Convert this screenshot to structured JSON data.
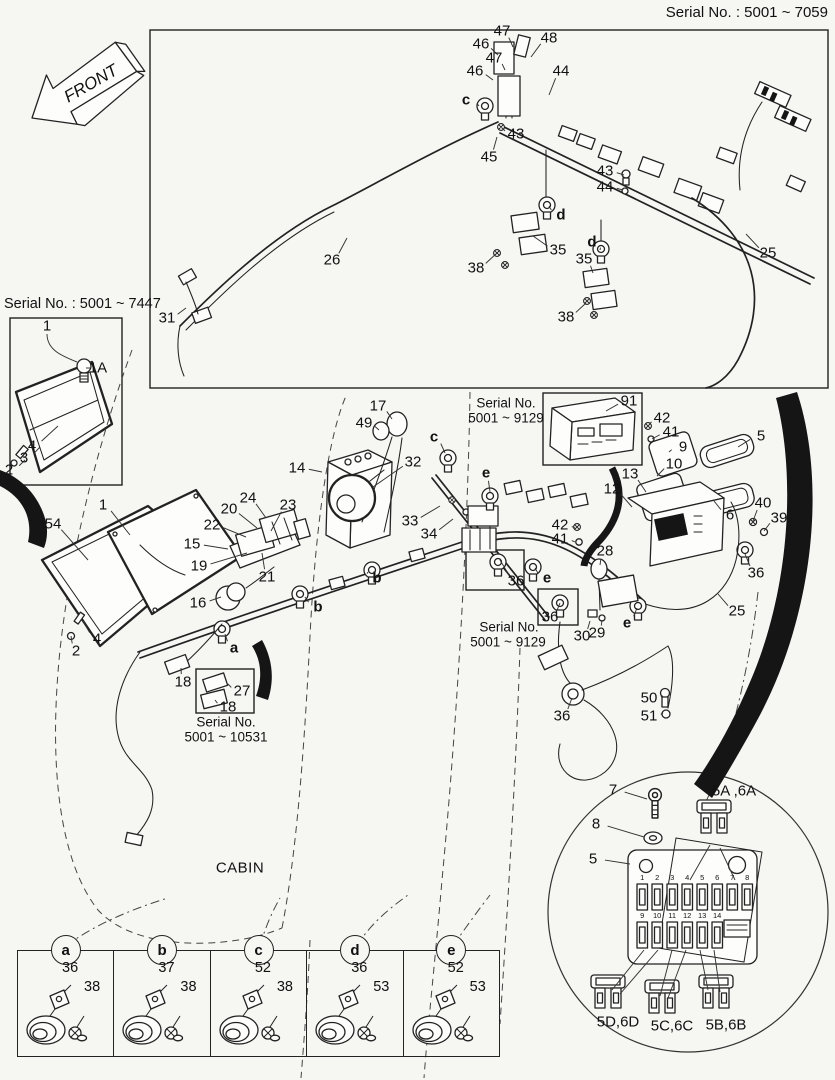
{
  "front_arrow": {
    "label": "FRONT"
  },
  "headers": {
    "top_right_serial": "Serial No. : 5001 ~ 7059",
    "left_box_serial": "Serial No. : 5001 ~ 7447"
  },
  "callouts": [
    {
      "t": "47",
      "x": 502,
      "y": 31,
      "tx": 513,
      "ty": 47
    },
    {
      "t": "46",
      "x": 481,
      "y": 44,
      "tx": 498,
      "ty": 55
    },
    {
      "t": "47",
      "x": 494,
      "y": 58,
      "tx": 505,
      "ty": 70
    },
    {
      "t": "46",
      "x": 475,
      "y": 71,
      "tx": 493,
      "ty": 80
    },
    {
      "t": "48",
      "x": 549,
      "y": 38,
      "tx": 531,
      "ty": 57
    },
    {
      "t": "44",
      "x": 561,
      "y": 71,
      "tx": 549,
      "ty": 95
    },
    {
      "t": "c",
      "x": 466,
      "y": 100,
      "cls": "letter",
      "tx": 479,
      "ty": 106
    },
    {
      "t": "43",
      "x": 516,
      "y": 134,
      "tx": 502,
      "ty": 128
    },
    {
      "t": "45",
      "x": 489,
      "y": 157,
      "tx": 497,
      "ty": 137
    },
    {
      "t": "43",
      "x": 605,
      "y": 171,
      "tx": 624,
      "ty": 175
    },
    {
      "t": "44",
      "x": 605,
      "y": 187,
      "tx": 623,
      "ty": 190
    },
    {
      "t": "d",
      "x": 561,
      "y": 215,
      "cls": "letter",
      "tx": 549,
      "ty": 206
    },
    {
      "t": "35",
      "x": 558,
      "y": 250,
      "tx": 533,
      "ty": 236
    },
    {
      "t": "38",
      "x": 476,
      "y": 268,
      "tx": 497,
      "ty": 253
    },
    {
      "t": "d",
      "x": 592,
      "y": 242,
      "cls": "letter",
      "tx": 600,
      "ty": 250
    },
    {
      "t": "35",
      "x": 584,
      "y": 259,
      "tx": 593,
      "ty": 273
    },
    {
      "t": "38",
      "x": 566,
      "y": 317,
      "tx": 586,
      "ty": 303
    },
    {
      "t": "26",
      "x": 332,
      "y": 260,
      "tx": 347,
      "ty": 238
    },
    {
      "t": "31",
      "x": 167,
      "y": 318,
      "tx": 186,
      "ty": 308
    },
    {
      "t": "25",
      "x": 768,
      "y": 253,
      "tx": 746,
      "ty": 234
    },
    {
      "t": "1",
      "x": 47,
      "y": 326
    },
    {
      "t": "1A",
      "x": 98,
      "y": 368,
      "tx": 90,
      "ty": 368
    },
    {
      "t": "4",
      "x": 32,
      "y": 446,
      "tx": 58,
      "ty": 426
    },
    {
      "t": "3",
      "x": 24,
      "y": 458,
      "tx": 40,
      "ty": 447
    },
    {
      "t": "2",
      "x": 9,
      "y": 470,
      "tx": 25,
      "ty": 460
    },
    {
      "t": "54",
      "x": 53,
      "y": 524,
      "tx": 88,
      "ty": 560
    },
    {
      "t": "1",
      "x": 103,
      "y": 505,
      "tx": 130,
      "ty": 535
    },
    {
      "t": "4",
      "x": 97,
      "y": 639,
      "tx": 83,
      "ty": 621
    },
    {
      "t": "2",
      "x": 76,
      "y": 651,
      "tx": 71,
      "ty": 636
    },
    {
      "t": "15",
      "x": 192,
      "y": 544,
      "tx": 228,
      "ty": 549
    },
    {
      "t": "19",
      "x": 199,
      "y": 566,
      "tx": 247,
      "ty": 553
    },
    {
      "t": "22",
      "x": 212,
      "y": 525,
      "tx": 246,
      "ty": 537
    },
    {
      "t": "20",
      "x": 229,
      "y": 509,
      "tx": 257,
      "ty": 528
    },
    {
      "t": "24",
      "x": 248,
      "y": 498,
      "tx": 266,
      "ty": 518
    },
    {
      "t": "23",
      "x": 288,
      "y": 505,
      "tx": 271,
      "ty": 531
    },
    {
      "t": "21",
      "x": 267,
      "y": 577,
      "tx": 262,
      "ty": 553
    },
    {
      "t": "16",
      "x": 198,
      "y": 603,
      "tx": 221,
      "ty": 597
    },
    {
      "t": "b",
      "x": 318,
      "y": 607,
      "cls": "letter",
      "tx": 305,
      "ty": 597
    },
    {
      "t": "b",
      "x": 377,
      "y": 578,
      "cls": "letter",
      "tx": 368,
      "ty": 572
    },
    {
      "t": "a",
      "x": 234,
      "y": 648,
      "cls": "letter",
      "tx": 225,
      "ty": 634
    },
    {
      "t": "18",
      "x": 183,
      "y": 682,
      "tx": 181,
      "ty": 668
    },
    {
      "t": "27",
      "x": 242,
      "y": 691,
      "tx": 228,
      "ty": 684
    },
    {
      "t": "18",
      "x": 228,
      "y": 707,
      "tx": 215,
      "ty": 700
    },
    {
      "t": "Serial No.",
      "x": 226,
      "y": 722,
      "cls": "serial"
    },
    {
      "t": "5001 ~ 10531",
      "x": 226,
      "y": 737,
      "cls": "serial"
    },
    {
      "t": "17",
      "x": 378,
      "y": 406,
      "tx": 392,
      "ty": 419
    },
    {
      "t": "49",
      "x": 364,
      "y": 423,
      "tx": 379,
      "ty": 430
    },
    {
      "t": "14",
      "x": 297,
      "y": 468,
      "tx": 322,
      "ty": 472
    },
    {
      "t": "32",
      "x": 413,
      "y": 462,
      "tx": 373,
      "ty": 487
    },
    {
      "t": "c",
      "x": 434,
      "y": 437,
      "cls": "letter",
      "tx": 445,
      "ty": 453
    },
    {
      "t": "33",
      "x": 410,
      "y": 521,
      "tx": 440,
      "ty": 506
    },
    {
      "t": "34",
      "x": 429,
      "y": 534,
      "tx": 453,
      "ty": 519
    },
    {
      "t": "e",
      "x": 486,
      "y": 473,
      "cls": "letter",
      "tx": 490,
      "ty": 492
    },
    {
      "t": "Serial No.",
      "x": 506,
      "y": 403,
      "cls": "serial"
    },
    {
      "t": "5001 ~ 9129",
      "x": 506,
      "y": 418,
      "cls": "serial"
    },
    {
      "t": "91",
      "x": 629,
      "y": 401,
      "tx": 606,
      "ty": 411
    },
    {
      "t": "42",
      "x": 662,
      "y": 418,
      "tx": 649,
      "ty": 425
    },
    {
      "t": "41",
      "x": 671,
      "y": 432,
      "tx": 652,
      "ty": 439
    },
    {
      "t": "9",
      "x": 683,
      "y": 447,
      "tx": 669,
      "ty": 452
    },
    {
      "t": "5",
      "x": 761,
      "y": 436,
      "tx": 738,
      "ty": 447
    },
    {
      "t": "10",
      "x": 674,
      "y": 464,
      "tx": 657,
      "ty": 476
    },
    {
      "t": "13",
      "x": 630,
      "y": 474,
      "tx": 646,
      "ty": 492
    },
    {
      "t": "12",
      "x": 612,
      "y": 489,
      "tx": 632,
      "ty": 507
    },
    {
      "t": "6",
      "x": 730,
      "y": 515,
      "tx": 714,
      "ty": 501
    },
    {
      "t": "40",
      "x": 763,
      "y": 503,
      "tx": 753,
      "ty": 521
    },
    {
      "t": "39",
      "x": 779,
      "y": 518,
      "tx": 764,
      "ty": 531
    },
    {
      "t": "36",
      "x": 756,
      "y": 573,
      "tx": 745,
      "ty": 554
    },
    {
      "t": "42",
      "x": 560,
      "y": 525,
      "tx": 575,
      "ty": 528
    },
    {
      "t": "41",
      "x": 560,
      "y": 539,
      "tx": 575,
      "ty": 542
    },
    {
      "t": "28",
      "x": 605,
      "y": 551,
      "tx": 600,
      "ty": 565
    },
    {
      "t": "e",
      "x": 547,
      "y": 578,
      "cls": "letter",
      "tx": 535,
      "ty": 568
    },
    {
      "t": "36",
      "x": 516,
      "y": 581,
      "tx": 500,
      "ty": 560
    },
    {
      "t": "36",
      "x": 550,
      "y": 617,
      "tx": 560,
      "ty": 603
    },
    {
      "t": "30",
      "x": 582,
      "y": 636,
      "tx": 590,
      "ty": 621
    },
    {
      "t": "29",
      "x": 597,
      "y": 633,
      "tx": 602,
      "ty": 620
    },
    {
      "t": "e",
      "x": 627,
      "y": 623,
      "cls": "letter",
      "tx": 637,
      "ty": 608
    },
    {
      "t": "Serial No.",
      "x": 509,
      "y": 627,
      "cls": "serial"
    },
    {
      "t": "5001 ~ 9129",
      "x": 508,
      "y": 642,
      "cls": "serial"
    },
    {
      "t": "25",
      "x": 737,
      "y": 611,
      "tx": 718,
      "ty": 594
    },
    {
      "t": "36",
      "x": 562,
      "y": 716,
      "tx": 572,
      "ty": 698
    },
    {
      "t": "50",
      "x": 649,
      "y": 698,
      "tx": 663,
      "ty": 696
    },
    {
      "t": "51",
      "x": 649,
      "y": 716,
      "tx": 663,
      "ty": 713
    },
    {
      "t": "CABIN",
      "x": 240,
      "y": 868,
      "cls": "cabin"
    },
    {
      "t": "7",
      "x": 613,
      "y": 790,
      "tx": 647,
      "ty": 799
    },
    {
      "t": "8",
      "x": 596,
      "y": 824,
      "tx": 644,
      "ty": 837
    },
    {
      "t": "5",
      "x": 593,
      "y": 859,
      "tx": 630,
      "ty": 864
    },
    {
      "t": "5A ,6A",
      "x": 734,
      "y": 791
    },
    {
      "t": "5D,6D",
      "x": 618,
      "y": 1022
    },
    {
      "t": "5C,6C",
      "x": 672,
      "y": 1026
    },
    {
      "t": "5B,6B",
      "x": 726,
      "y": 1025
    }
  ],
  "fuse_detail": {
    "slot_numbers_top": [
      "1",
      "2",
      "3",
      "4",
      "5",
      "6",
      "7",
      "8"
    ],
    "slot_numbers_bottom": [
      "9",
      "10",
      "11",
      "12",
      "13",
      "14"
    ]
  },
  "legend": {
    "cells": [
      {
        "letter": "a",
        "part_top": "36",
        "part_right": "38"
      },
      {
        "letter": "b",
        "part_top": "37",
        "part_right": "38"
      },
      {
        "letter": "c",
        "part_top": "52",
        "part_right": "38"
      },
      {
        "letter": "d",
        "part_top": "36",
        "part_right": "53"
      },
      {
        "letter": "e",
        "part_top": "52",
        "part_right": "53"
      }
    ]
  }
}
